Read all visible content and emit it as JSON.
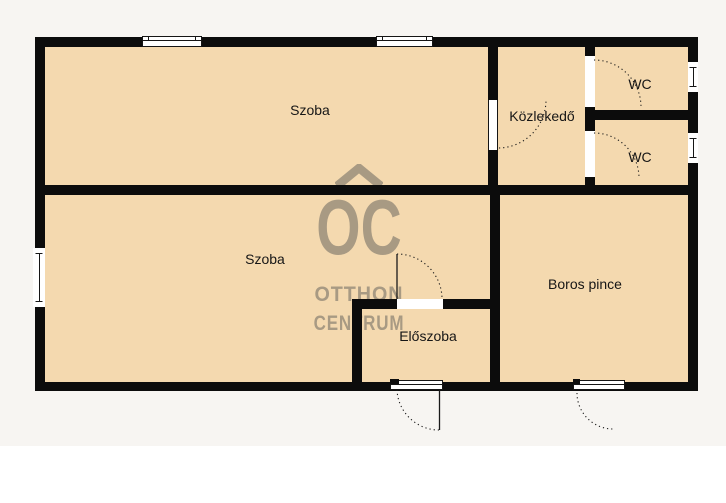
{
  "watermark": {
    "logo_text": "OC",
    "line1": "OTTHON",
    "line2": "CENTRUM"
  },
  "rooms": [
    {
      "id": "szoba-top",
      "label": "Szoba"
    },
    {
      "id": "kozlekedo",
      "label": "Közlekedő"
    },
    {
      "id": "wc-upper",
      "label": "WC"
    },
    {
      "id": "wc-lower",
      "label": "WC"
    },
    {
      "id": "szoba-bottom",
      "label": "Szoba"
    },
    {
      "id": "boros-pince",
      "label": "Boros pince"
    },
    {
      "id": "eloszoba",
      "label": "Előszoba"
    }
  ],
  "colors": {
    "room_fill": "#f4d9af",
    "wall": "#0c0c0c",
    "background": "#f7f5f2",
    "watermark": "#a89a83",
    "label_text": "#161616",
    "opening_white": "#ffffff"
  }
}
